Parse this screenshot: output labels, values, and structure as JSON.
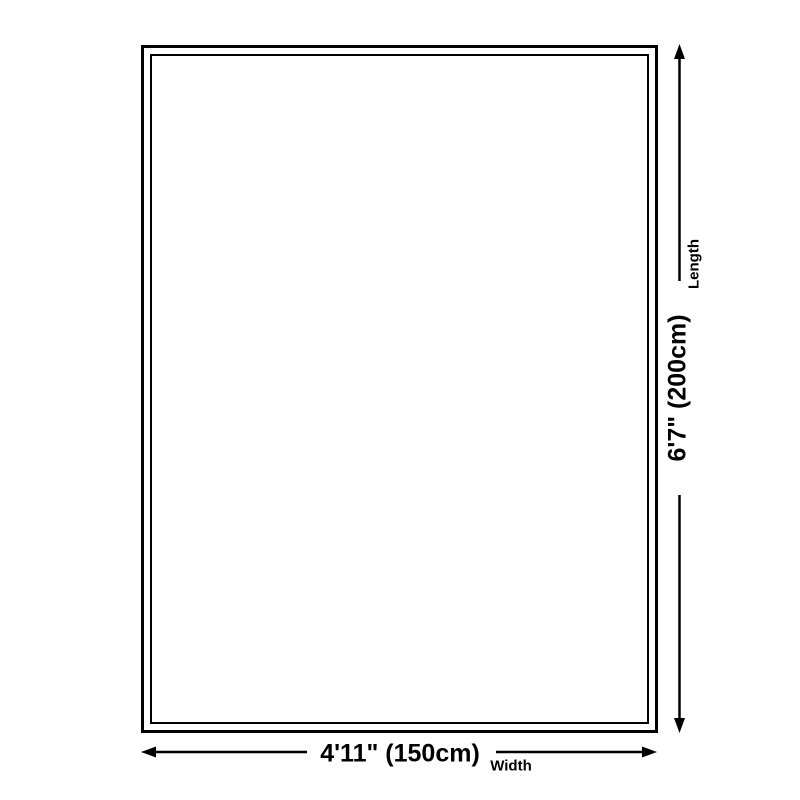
{
  "diagram": {
    "background_color": "#ffffff",
    "line_color": "#000000",
    "length": {
      "value": "6'7\" (200cm)",
      "label": "Length"
    },
    "width": {
      "value": "4'11\" (150cm)",
      "label": "Width"
    }
  }
}
